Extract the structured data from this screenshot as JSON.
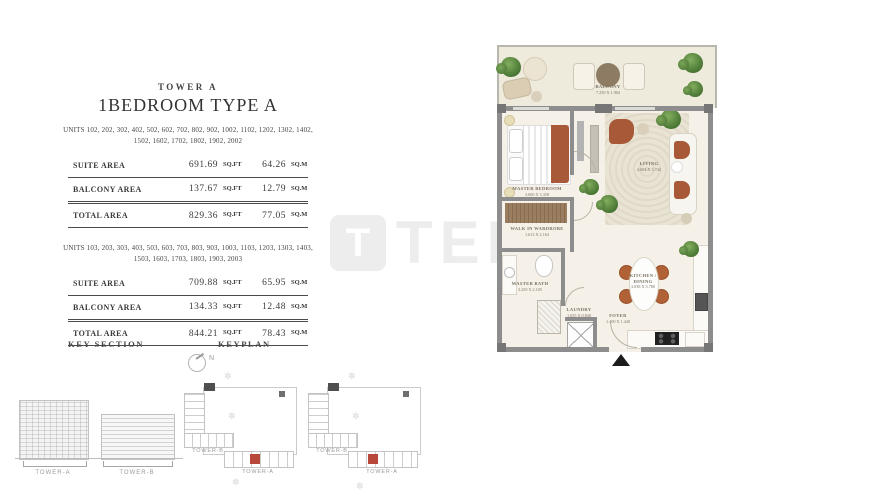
{
  "title_block": {
    "tower": "TOWER A",
    "title": "1BEDROOM TYPE A"
  },
  "tables": [
    {
      "units": "UNITS 102, 202, 302, 402, 502, 602, 702, 802, 902, 1002, 1102, 1202, 1302, 1402, 1502, 1602, 1702, 1802, 1902, 2002",
      "rows": [
        {
          "label": "SUITE AREA",
          "sqft": "691.69",
          "sqft_unit": "SQ.FT",
          "sqm": "64.26",
          "sqm_unit": "SQ.M"
        },
        {
          "label": "BALCONY AREA",
          "sqft": "137.67",
          "sqft_unit": "SQ.FT",
          "sqm": "12.79",
          "sqm_unit": "SQ.M"
        },
        {
          "label": "TOTAL AREA",
          "sqft": "829.36",
          "sqft_unit": "SQ.FT",
          "sqm": "77.05",
          "sqm_unit": "SQ.M"
        }
      ]
    },
    {
      "units": "UNITS 103, 203, 303, 403, 503, 603, 703, 803, 903, 1003, 1103, 1203, 1303, 1403, 1503, 1603, 1703, 1803, 1903, 2003",
      "rows": [
        {
          "label": "SUITE AREA",
          "sqft": "709.88",
          "sqft_unit": "SQ.FT",
          "sqm": "65.95",
          "sqm_unit": "SQ.M"
        },
        {
          "label": "BALCONY AREA",
          "sqft": "134.33",
          "sqft_unit": "SQ.FT",
          "sqm": "12.48",
          "sqm_unit": "SQ.M"
        },
        {
          "label": "TOTAL AREA",
          "sqft": "844.21",
          "sqft_unit": "SQ.FT",
          "sqm": "78.43",
          "sqm_unit": "SQ.M"
        }
      ]
    }
  ],
  "section_labels": {
    "key_section": "KEY SECTION",
    "keyplan": "KEYPLAN",
    "north": "N"
  },
  "key_section": {
    "tower_a": "TOWER-A",
    "tower_b": "TOWER-B"
  },
  "keyplans": [
    {
      "tower_b": "TOWER-B",
      "tower_a": "TOWER-A"
    },
    {
      "tower_b": "TOWER-B",
      "tower_a": "TOWER-A"
    }
  ],
  "floorplan": {
    "balcony": {
      "name": "BALCONY",
      "dim": "7.250 X 1.904"
    },
    "master_bedroom": {
      "name": "MASTER BEDROOM",
      "dim": "3.600 X 3.358"
    },
    "living": {
      "name": "LIVING",
      "dim": "4.684 X 3.744"
    },
    "wardrobe": {
      "name": "WALK IN WARDROBE",
      "dim": "1.613 X 2.164"
    },
    "master_bath": {
      "name": "MASTER BATH",
      "dim": "3.250 X 2.105"
    },
    "laundry": {
      "name": "LAUNDRY",
      "dim": "1.035 X 0.840"
    },
    "kitchen_dining": {
      "name": "KITCHEN / DINING",
      "dim": "3.038 X 3.780"
    },
    "foyer": {
      "name": "FOYER",
      "dim": "1.400 X 1.440"
    }
  },
  "watermark": {
    "logo_letter": "T",
    "text": "TEKCE"
  },
  "icons": {
    "deco": "✽"
  },
  "colors": {
    "wall": "#8d8d8d",
    "accent_rust": "#a85a38",
    "plant_green": "#4f7c38",
    "highlight_red": "#b8483a",
    "watermark": "#ededed"
  }
}
